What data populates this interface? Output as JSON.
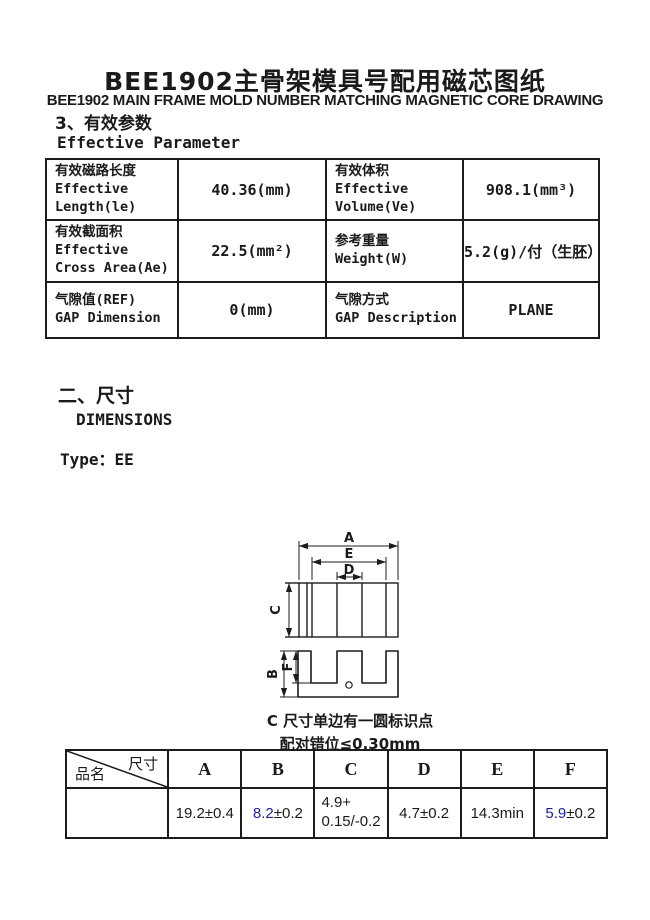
{
  "header": {
    "title_cn": "BEE1902主骨架模具号配用磁芯图纸",
    "title_en": "BEE1902 MAIN FRAME MOLD NUMBER MATCHING MAGNETIC CORE DRAWING"
  },
  "section_params": {
    "heading_cn": "3、有效参数",
    "heading_en": "Effective Parameter"
  },
  "param_table": {
    "rows": [
      {
        "c0": "有效磁路长度\nEffective\nLength(le)",
        "v0": "40.36(mm)",
        "c1": "有效体积\nEffective\nVolume(Ve)",
        "v1": "908.1(mm³)"
      },
      {
        "c0": "有效截面积\nEffective\nCross Area(Ae)",
        "v0": "22.5(mm²)",
        "c1": "参考重量\nWeight(W)",
        "v1": "5.2(g)/付（生胚）"
      },
      {
        "c0": "气隙值(REF)\nGAP Dimension",
        "v0": "0(mm)",
        "c1": "气隙方式\nGAP Description",
        "v1": "PLANE"
      }
    ]
  },
  "section_dims": {
    "heading_cn": "二、尺寸",
    "heading_en": "DIMENSIONS",
    "type_label": "Type：EE"
  },
  "diagram": {
    "labels": {
      "A": "A",
      "E": "E",
      "D": "D",
      "C": "C",
      "B": "B",
      "F": "F"
    },
    "note_line1": "C 尺寸单边有一圆标识点",
    "note_line2": "配对错位≤0.30mm"
  },
  "dim_table": {
    "corner_top": "尺寸",
    "corner_bottom": "品名",
    "headers": [
      "A",
      "B",
      "C",
      "D",
      "E",
      "F"
    ],
    "row": {
      "product_name": "",
      "A": "19.2±0.4",
      "B_blue": "8.2",
      "B_rest": "±0.2",
      "C_line1": "4.9+",
      "C_line2": "0.15/-0.2",
      "D": "4.7±0.2",
      "E": "14.3min",
      "F_blue": "5.9",
      "F_rest": "±0.2"
    }
  },
  "colors": {
    "accent_blue": "#1f1f9c",
    "ink": "#1a1a1a"
  }
}
